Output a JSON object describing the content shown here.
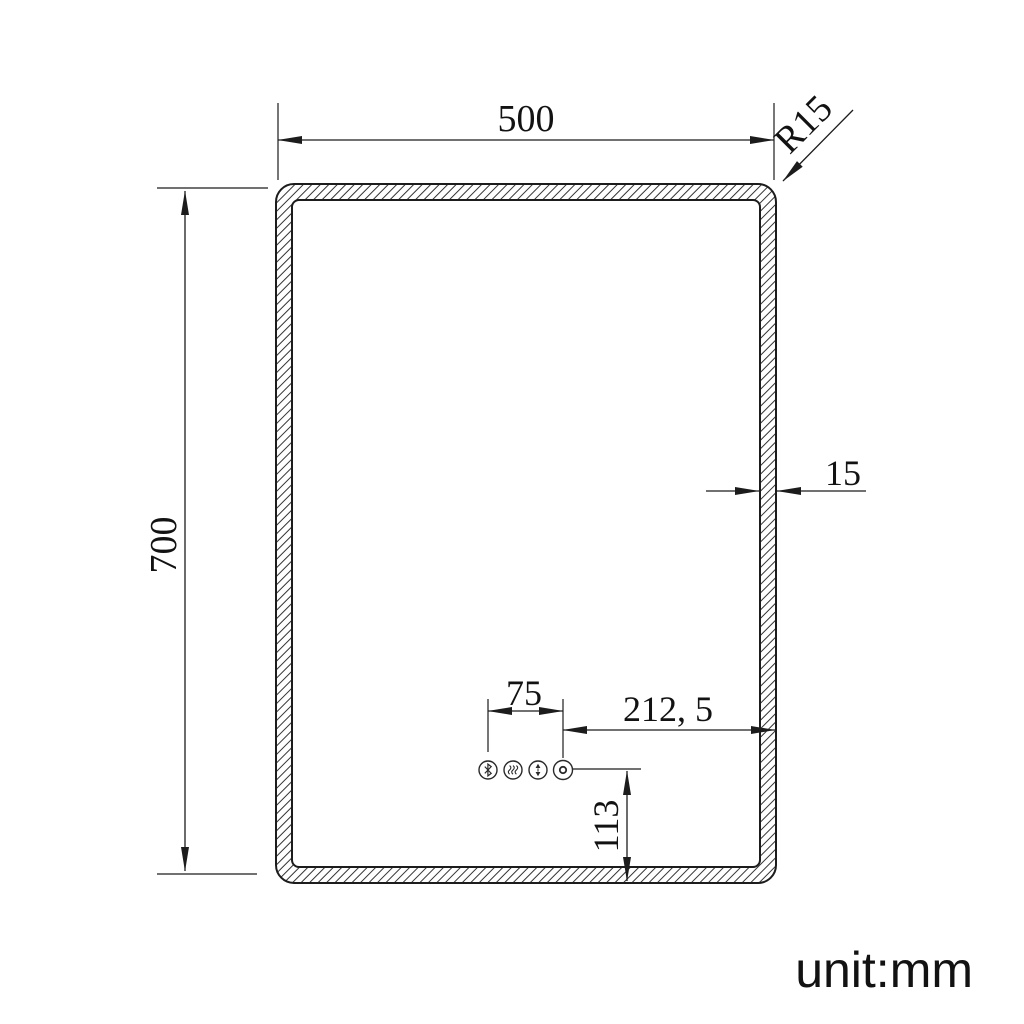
{
  "drawing": {
    "unit_note": "unit:mm",
    "dims": {
      "width": "500",
      "height": "700",
      "corner_radius": "R15",
      "frame_thickness": "15",
      "button_pitch": "75",
      "button_offset_right": "212, 5",
      "button_offset_bottom": "113"
    },
    "icons": [
      {
        "name": "bluetooth-icon"
      },
      {
        "name": "defogger-heat-icon"
      },
      {
        "name": "dimmer-icon"
      },
      {
        "name": "indicator-dot-icon"
      }
    ],
    "colors": {
      "line": "#1c1c1c",
      "background": "#ffffff",
      "text": "#121212"
    }
  }
}
